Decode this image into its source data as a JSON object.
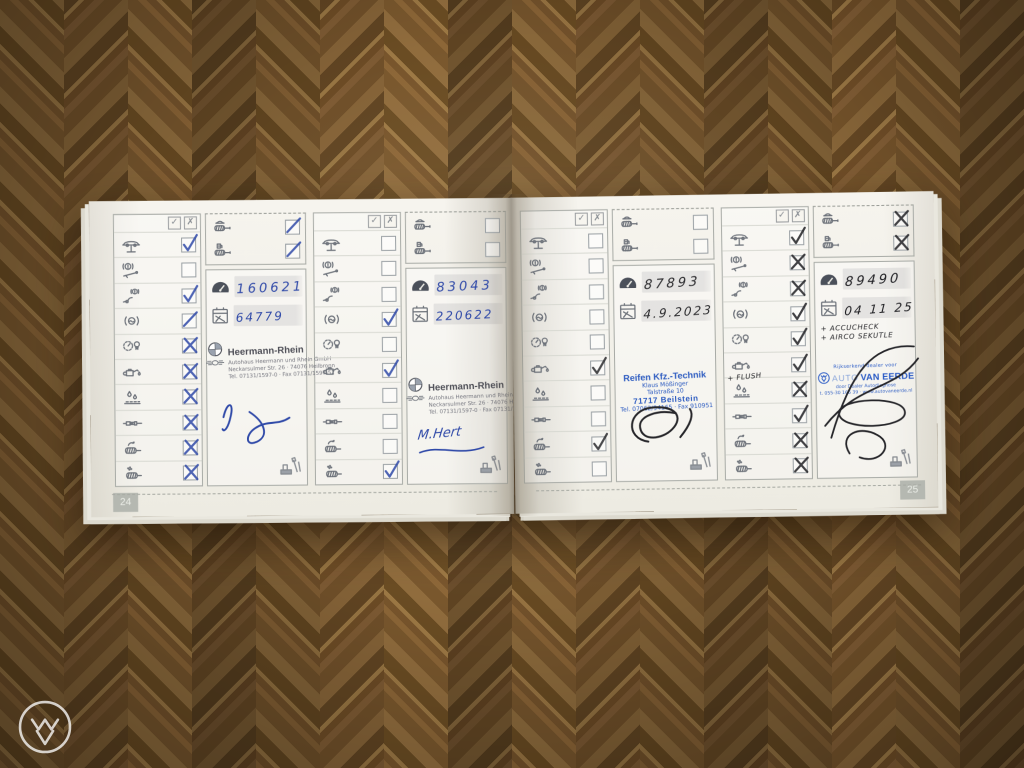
{
  "photo": {
    "subject": "Open vehicle service booklet lying on parquet wood floor",
    "left_page_number": "24",
    "right_page_number": "25"
  },
  "legend": {
    "check_symbol": "✓",
    "cross_symbol": "✗"
  },
  "checklist_items": [
    {
      "name": "vehicle-on-lift"
    },
    {
      "name": "parking-brake-check"
    },
    {
      "name": "brake-warning-check"
    },
    {
      "name": "brake-fluid-check"
    },
    {
      "name": "tire-pressure-and-lights"
    },
    {
      "name": "engine-oil-service"
    },
    {
      "name": "leak-check"
    },
    {
      "name": "spark-plugs"
    },
    {
      "name": "air-filter"
    },
    {
      "name": "pollen-filter"
    }
  ],
  "exhaust_items": [
    {
      "name": "exhaust-emission-petrol"
    },
    {
      "name": "exhaust-emission-diesel"
    }
  ],
  "entries": [
    {
      "odometer": "160621",
      "date": "64779",
      "pen_color": "#2f49a8",
      "marks": [
        "check",
        "none",
        "check",
        "slash",
        "cross",
        "cross",
        "cross",
        "cross",
        "cross",
        "cross"
      ],
      "exhaust_marks": [
        "slash",
        "slash"
      ],
      "stamp": "heermann",
      "signature": "blue-scribble",
      "notes": []
    },
    {
      "odometer": "83043",
      "date": "220622",
      "pen_color": "#2f49a8",
      "marks": [
        "none",
        "none",
        "none",
        "check",
        "none",
        "check",
        "none",
        "none",
        "none",
        "check"
      ],
      "exhaust_marks": [
        "none",
        "none"
      ],
      "stamp": "heermann",
      "signature_text": "M.Hert",
      "notes": []
    },
    {
      "odometer": "87893",
      "date": "4.9.2023",
      "pen_color": "#2b2b2e",
      "marks": [
        "none",
        "none",
        "none",
        "none",
        "none",
        "check",
        "none",
        "none",
        "check",
        "none"
      ],
      "exhaust_marks": [
        "none",
        "none"
      ],
      "stamp": "reifen",
      "signature": "black-scribble",
      "notes": []
    },
    {
      "odometer": "89490",
      "date": "04 11 25",
      "pen_color": "#202024",
      "marks": [
        "check",
        "cross",
        "cross",
        "check",
        "check",
        "check",
        "cross",
        "check",
        "cross",
        "cross"
      ],
      "exhaust_marks": [
        "cross",
        "cross"
      ],
      "stamp": "vaneerde",
      "signature": "black-scribble-large",
      "notes": [
        "+ ACCUCHECK",
        "+ AIRCO SEKUTLE"
      ],
      "oil_row_note": "+ FLUSH"
    }
  ],
  "stamps": {
    "heermann": {
      "brand": "Heermann-Rhein",
      "lines": [
        "Autohaus Heermann und Rhein GmbH",
        "Neckarsulmer Str. 26 · 74076 Heilbronn",
        "Tel. 07131/1597-0 · Fax 07131/1597-52"
      ]
    },
    "reifen": {
      "brand": "Reifen Kfz.-Technik",
      "lines": [
        "Klaus Mößinger",
        "Talstraße 10"
      ],
      "city": "71717 Beilstein",
      "phone": "Tel. 07062/94165 · Fax 910951"
    },
    "vaneerde": {
      "top": "Rijkserkend dealer voor",
      "brand_light": "AUTO",
      "brand_bold": "VAN EERDE",
      "lines": [
        "door Dealer Autodiagnose",
        "t. 055-30 166 39 · www.autovaneerde.nl"
      ]
    }
  }
}
